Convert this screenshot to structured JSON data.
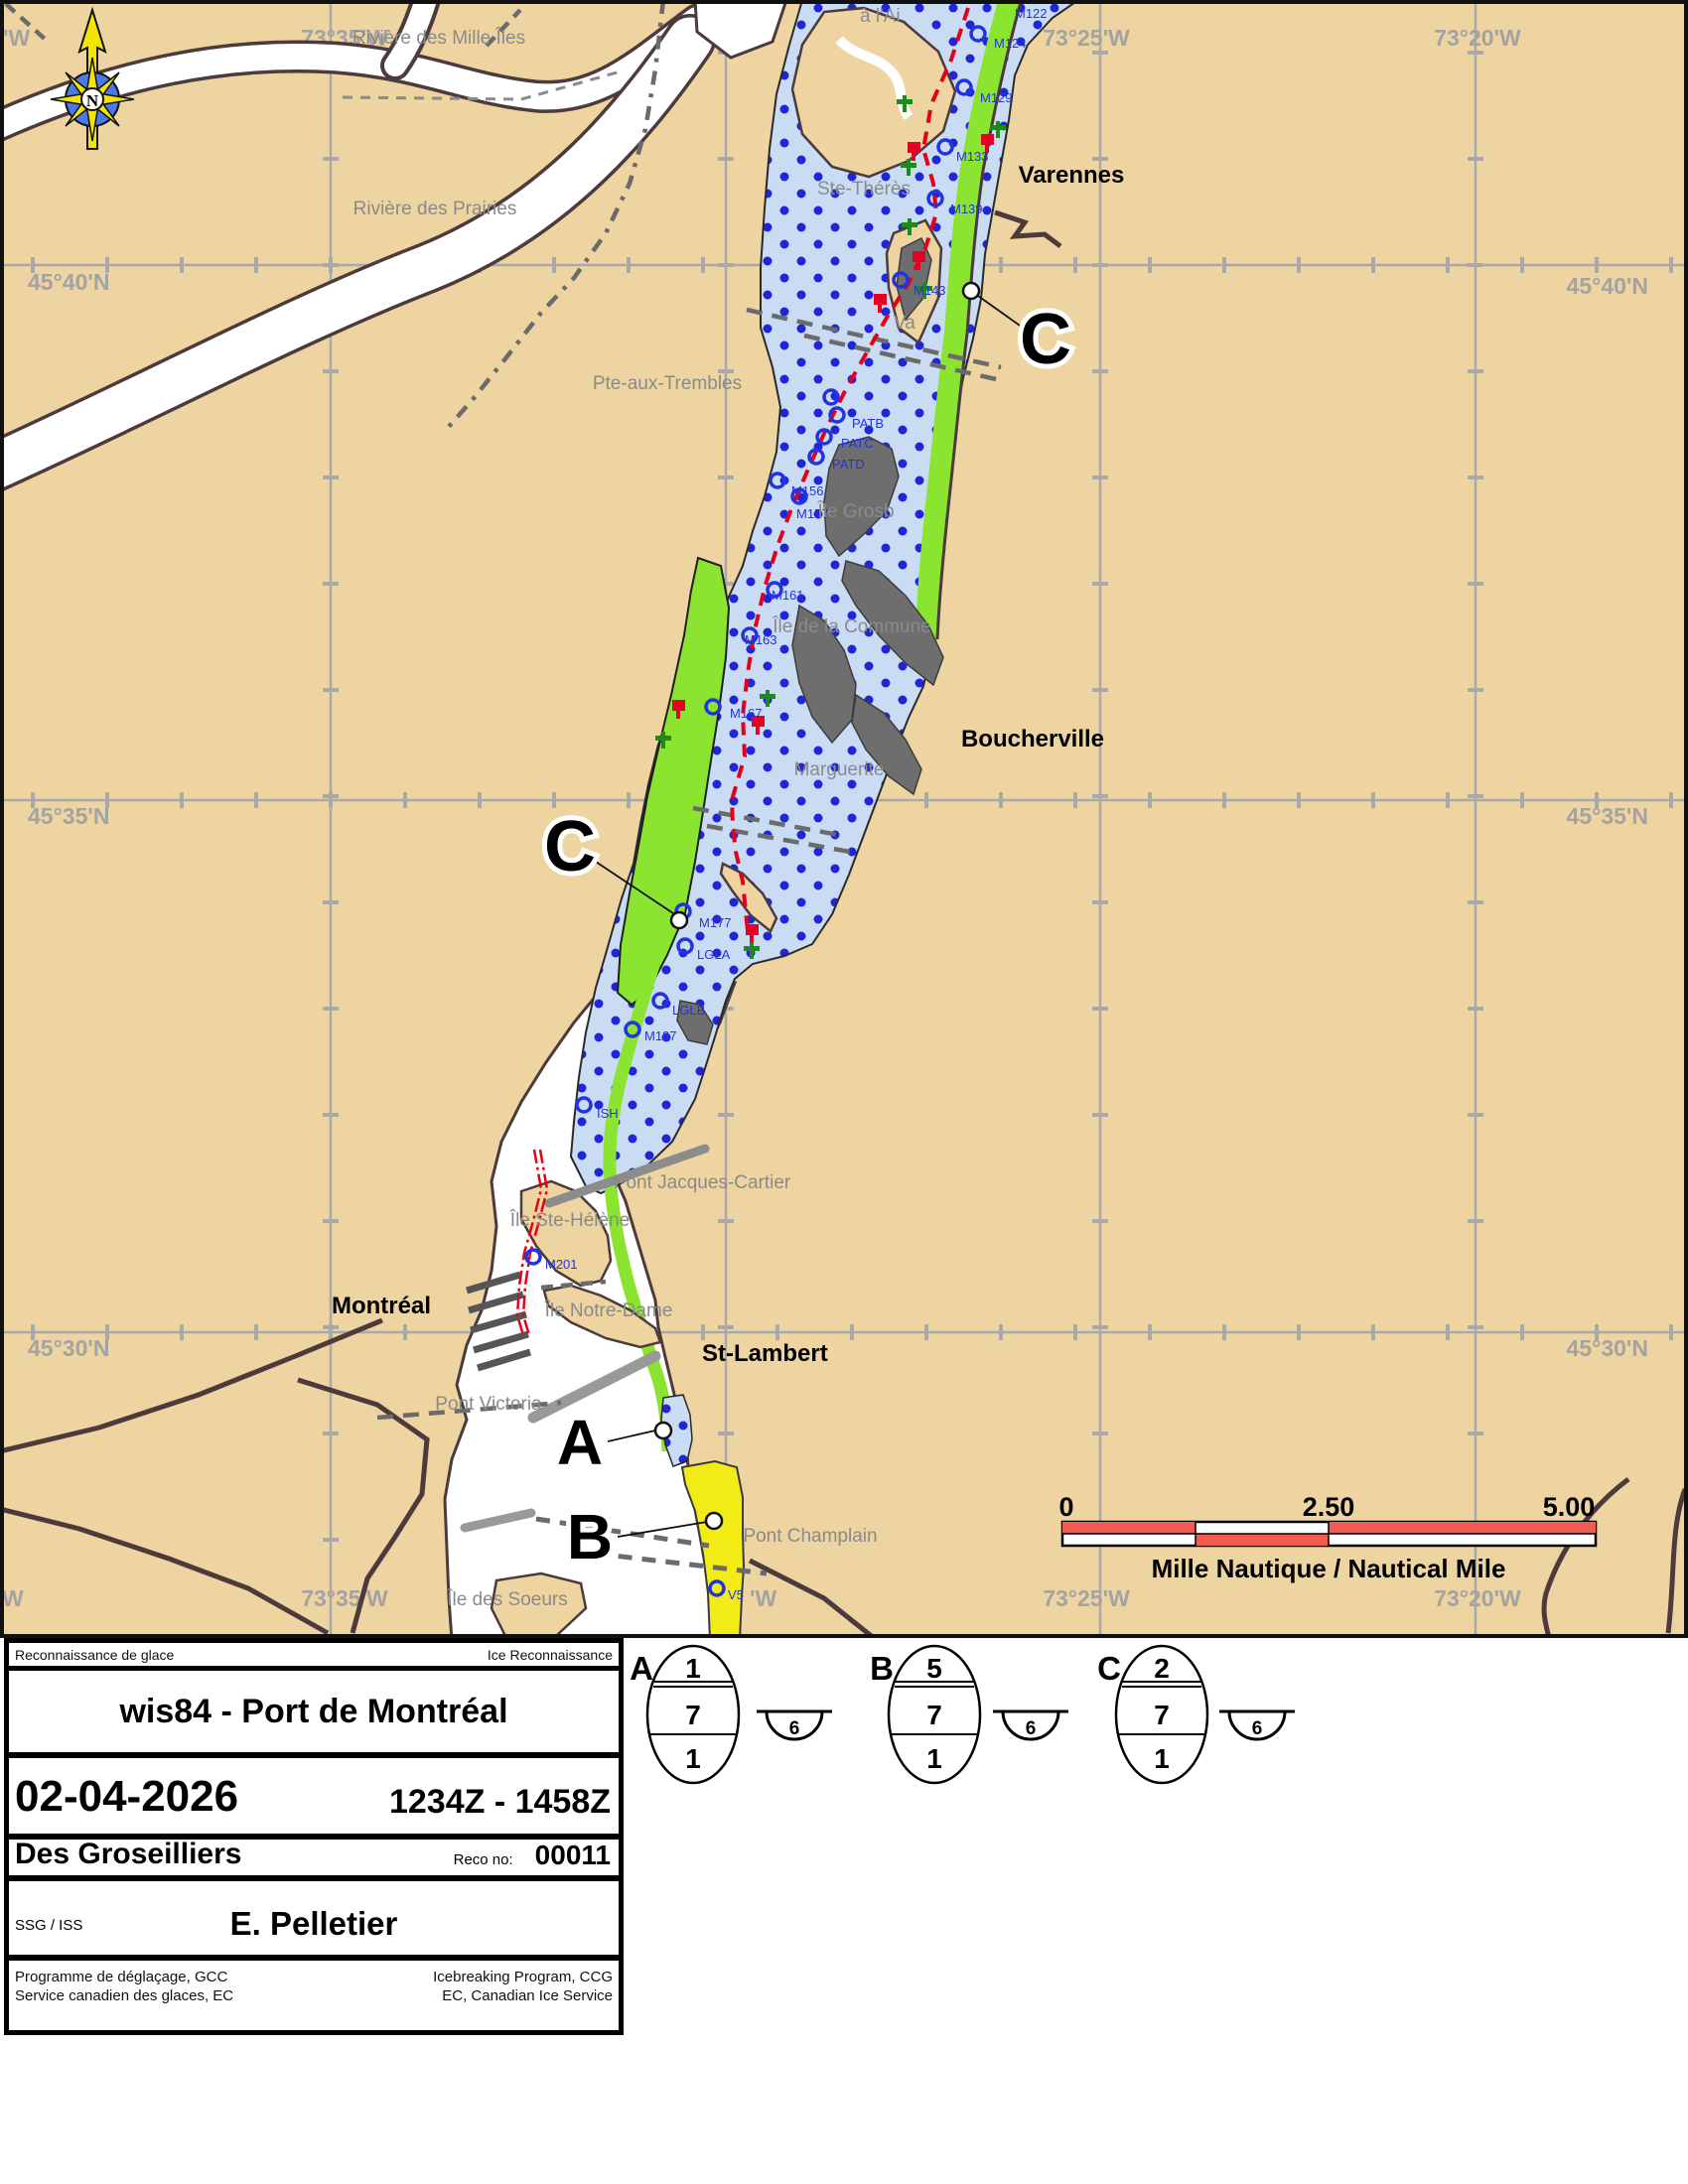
{
  "map": {
    "compass_letter": "N",
    "grid": {
      "top": [
        "'W",
        "73°35'W",
        "73°30'W",
        "73°25'W",
        "73°20'W"
      ],
      "bottom": [
        "W",
        "73°35'W",
        "73°",
        "'W",
        "73°25'W",
        "73°20'W"
      ],
      "left": [
        "45°40'N",
        "45°35'N",
        "45°30'N"
      ],
      "right": [
        "45°40'N",
        "45°35'N",
        "45°30'N"
      ]
    },
    "places": {
      "riviere_mille_iles": "Rivière des Mille Îles",
      "riviere_prairies": "Rivière des Prairies",
      "a_l_ai": "à l'Ai",
      "ste_therese": "Ste-Thérès",
      "pte_aux_trembles": "Pte-aux-Trembles",
      "va": "Va",
      "ile_grosbois": "Île Grosb",
      "ile_commune": "Île de la Commune",
      "marguerite": "Marguerite",
      "pont_jacques_cartier": "Pont Jacques-Cartier",
      "ile_ste_helene": "Île Ste-Hélène",
      "ile_notre_dame": "Île Notre-Dame",
      "pont_victoria": "Pont Victoria",
      "pont_champlain": "Pont Champlain",
      "ile_des_soeurs": "Île des Soeurs"
    },
    "cities": {
      "varennes": "Varennes",
      "boucherville": "Boucherville",
      "montreal": "Montréal",
      "st_lambert": "St-Lambert"
    },
    "buoys": [
      "M122",
      "M124",
      "M129",
      "M133",
      "M139",
      "M143",
      "PATB",
      "PATC",
      "PATD",
      "M156",
      "M157",
      "M161",
      "M163",
      "M167",
      "M177",
      "LGLA",
      "LGLB",
      "M187",
      "ISH",
      "M201",
      "V5"
    ],
    "region_labels": {
      "top_c": "C",
      "mid_c": "C",
      "a": "A",
      "b": "B"
    },
    "scale_bar": {
      "start": "0",
      "middle": "2.50",
      "end": "5.00",
      "caption": "Mille Nautique / Nautical Mile"
    }
  },
  "panel": {
    "header_left": "Reconnaissance de glace",
    "header_right": "Ice Reconnaissance",
    "title": "wis84 - Port de Montréal",
    "date": "02-04-2026",
    "time_range": "1234Z - 1458Z",
    "ship": "Des Groseilliers",
    "reco_label": "Reco no:",
    "reco_number": "00011",
    "observer_label": "SSG / ISS",
    "observer": "E. Pelletier",
    "footer_fr_1": "Programme de déglaçage, GCC",
    "footer_en_1": "Icebreaking Program, CCG",
    "footer_fr_2": "Service canadien des glaces, EC",
    "footer_en_2": "EC, Canadian Ice Service"
  },
  "egg_codes": [
    {
      "label": "A",
      "concentration": "1",
      "stage": "7",
      "form": "1",
      "fast": "6"
    },
    {
      "label": "B",
      "concentration": "5",
      "stage": "7",
      "form": "1",
      "fast": "6"
    },
    {
      "label": "C",
      "concentration": "2",
      "stage": "7",
      "form": "1",
      "fast": "6"
    }
  ],
  "colors": {
    "land": "#EDD4A0",
    "water": "#FFFFFF",
    "ice": "#C9DCF4",
    "ice_dot": "#2026D6",
    "green_strip": "#8BE430",
    "yellow_strip": "#F2EB16",
    "gray_island": "#6E6E6E",
    "shoreline": "#4C3A3C",
    "grid_gray": "#A9A9A9",
    "track_red": "#E50019",
    "buoy_red": "#E60023",
    "buoy_green": "#1E8A1E",
    "label_blue": "#2233E0",
    "scale_red": "#F25B52"
  }
}
